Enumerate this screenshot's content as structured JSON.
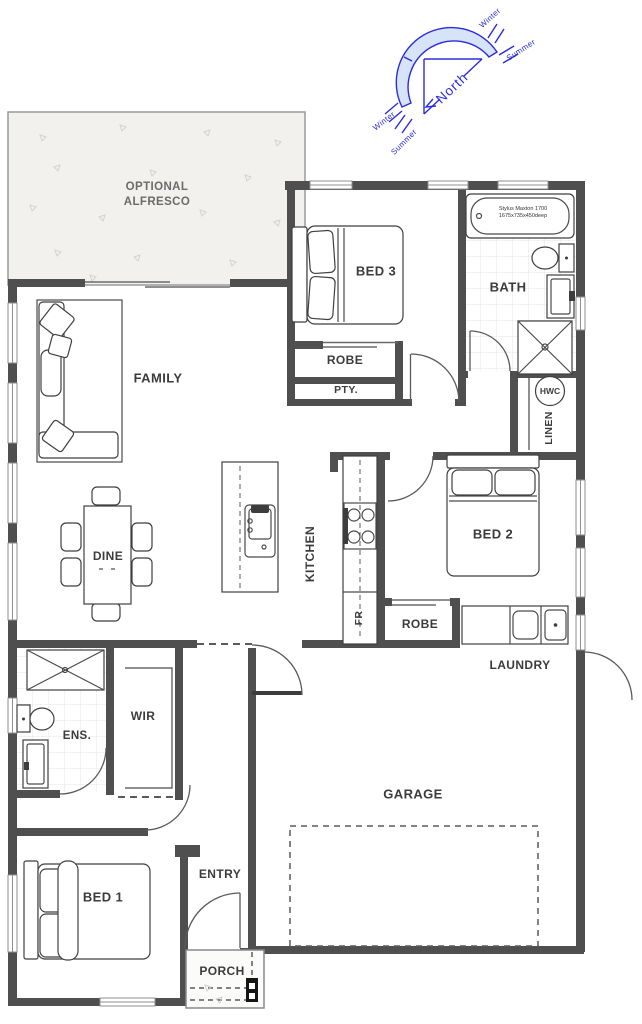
{
  "rooms": {
    "alfresco1": "OPTIONAL",
    "alfresco2": "ALFRESCO",
    "family": "FAMILY",
    "dine": "DINE",
    "kitchen": "KITCHEN",
    "bed3": "BED 3",
    "robe_bed3": "ROBE",
    "pty": "PTY.",
    "bath": "BATH",
    "hwc": "HWC",
    "linen": "LINEN",
    "bed2": "BED 2",
    "fr": "FR",
    "robe_bed2": "ROBE",
    "laundry": "LAUNDRY",
    "garage": "GARAGE",
    "ens": "ENS.",
    "wir": "WIR",
    "bed1": "BED 1",
    "entry": "ENTRY",
    "porch": "PORCH"
  },
  "fixtures": {
    "bath_model1": "Stylus Maxton 1700",
    "bath_model2": "1675x735x450deep"
  },
  "compass": {
    "north": "North",
    "winter": "Winter",
    "summer": "Summer"
  },
  "colors": {
    "wall": "#4f4f4f",
    "label": "#3c3c3c",
    "compass-blue": "#2b2be0",
    "compass-fill": "#d7e3f6",
    "alfresco-fill": "#f2f1ee"
  }
}
